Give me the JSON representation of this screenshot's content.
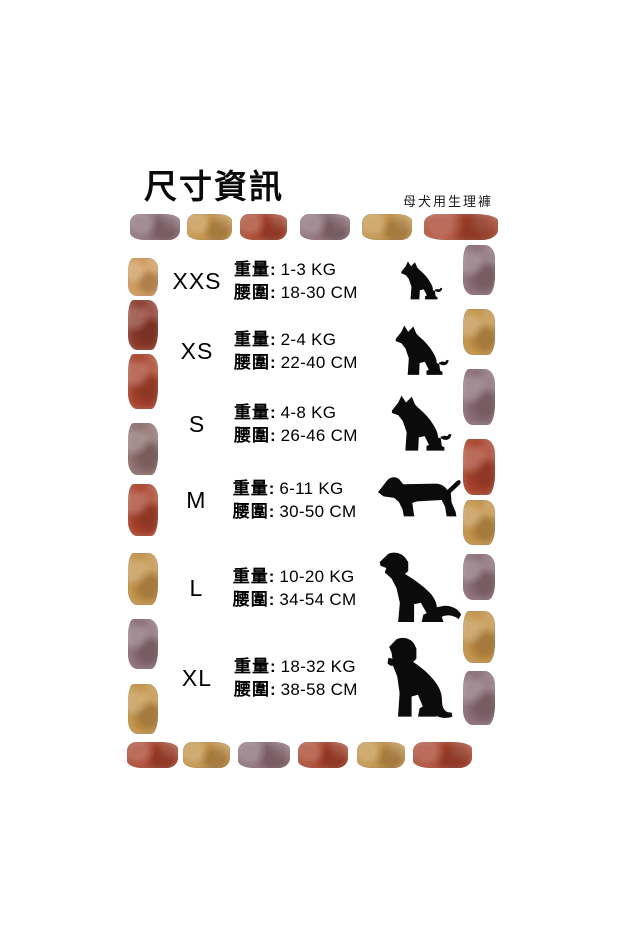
{
  "page": {
    "title": "尺寸資訊",
    "subtitle": "母犬用生理褲"
  },
  "labels": {
    "weight": "重量:",
    "waist": "腰圍:"
  },
  "sizes": [
    {
      "size": "XXS",
      "weight": "1-3 KG",
      "waist": "18-30 CM",
      "dog": "shepherd",
      "icon": "sitting-shepherd-puppy-icon"
    },
    {
      "size": "XS",
      "weight": "2-4 KG",
      "waist": "22-40 CM",
      "dog": "shepherd",
      "icon": "sitting-shepherd-small-icon"
    },
    {
      "size": "S",
      "weight": "4-8 KG",
      "waist": "26-46 CM",
      "dog": "shepherd",
      "icon": "sitting-shepherd-icon"
    },
    {
      "size": "M",
      "weight": "6-11 KG",
      "waist": "30-50 CM",
      "dog": "dachshund",
      "icon": "dachshund-icon"
    },
    {
      "size": "L",
      "weight": "10-20 KG",
      "waist": "34-54 CM",
      "dog": "retriever",
      "icon": "sitting-retriever-icon"
    },
    {
      "size": "XL",
      "weight": "18-32 KG",
      "waist": "38-58 CM",
      "dog": "labrador",
      "icon": "sitting-labrador-icon"
    }
  ],
  "palette": {
    "plum": "#8a6e78",
    "gold": "#c29349",
    "rust": "#a8432c",
    "tan": "#cf9a5c",
    "darkred": "#8c3a2b",
    "mauve": "#8d6f6d"
  },
  "border": {
    "top": [
      "plum",
      "gold",
      "rust",
      "plum",
      "gold",
      "rust"
    ],
    "bottom": [
      "rust",
      "gold",
      "plum",
      "rust",
      "gold",
      "rust"
    ],
    "left": [
      "tan",
      "darkred",
      "rust",
      "mauve",
      "rust",
      "gold",
      "plum",
      "gold"
    ],
    "right": [
      "plum",
      "gold",
      "plum",
      "rust",
      "gold",
      "plum",
      "gold",
      "plum"
    ]
  },
  "chart_data": {
    "type": "table",
    "title": "尺寸資訊",
    "subtitle": "母犬用生理褲",
    "columns": [
      "size",
      "weight",
      "waist"
    ],
    "rows": [
      [
        "XXS",
        "1-3 KG",
        "18-30 CM"
      ],
      [
        "XS",
        "2-4 KG",
        "22-40 CM"
      ],
      [
        "S",
        "4-8 KG",
        "26-46 CM"
      ],
      [
        "M",
        "6-11 KG",
        "30-50 CM"
      ],
      [
        "L",
        "10-20 KG",
        "34-54 CM"
      ],
      [
        "XL",
        "18-32 KG",
        "38-58 CM"
      ]
    ]
  }
}
